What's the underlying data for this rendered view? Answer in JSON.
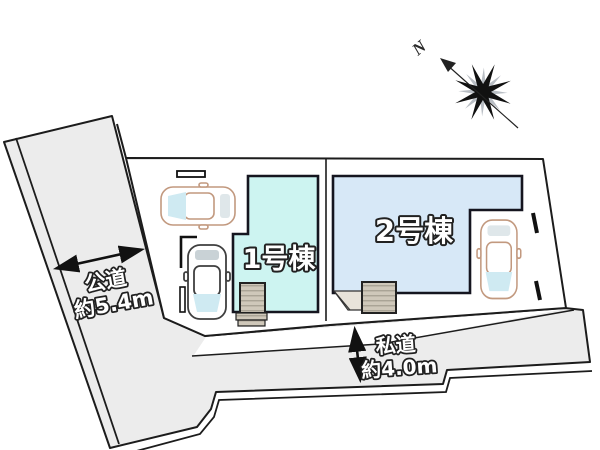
{
  "plan": {
    "compass": {
      "north_label": "N"
    },
    "buildings": [
      {
        "label": "1号棟",
        "fill": "#cdf4f1"
      },
      {
        "label": "2号棟",
        "fill": "#d7e8f7"
      }
    ],
    "roads": {
      "public": {
        "name": "公道",
        "width_label": "約5.4m"
      },
      "private": {
        "name": "私道",
        "width_label": "約4.0m"
      }
    },
    "colors": {
      "road_fill": "#ececec",
      "lot_fill": "#ffffff",
      "outline": "#1c1c1c",
      "porch_fill": "#cfc8ba",
      "car_outline": "#c2997f",
      "car_outline_dark": "#3f3f3f",
      "windshield": "#cfeaf2"
    }
  }
}
